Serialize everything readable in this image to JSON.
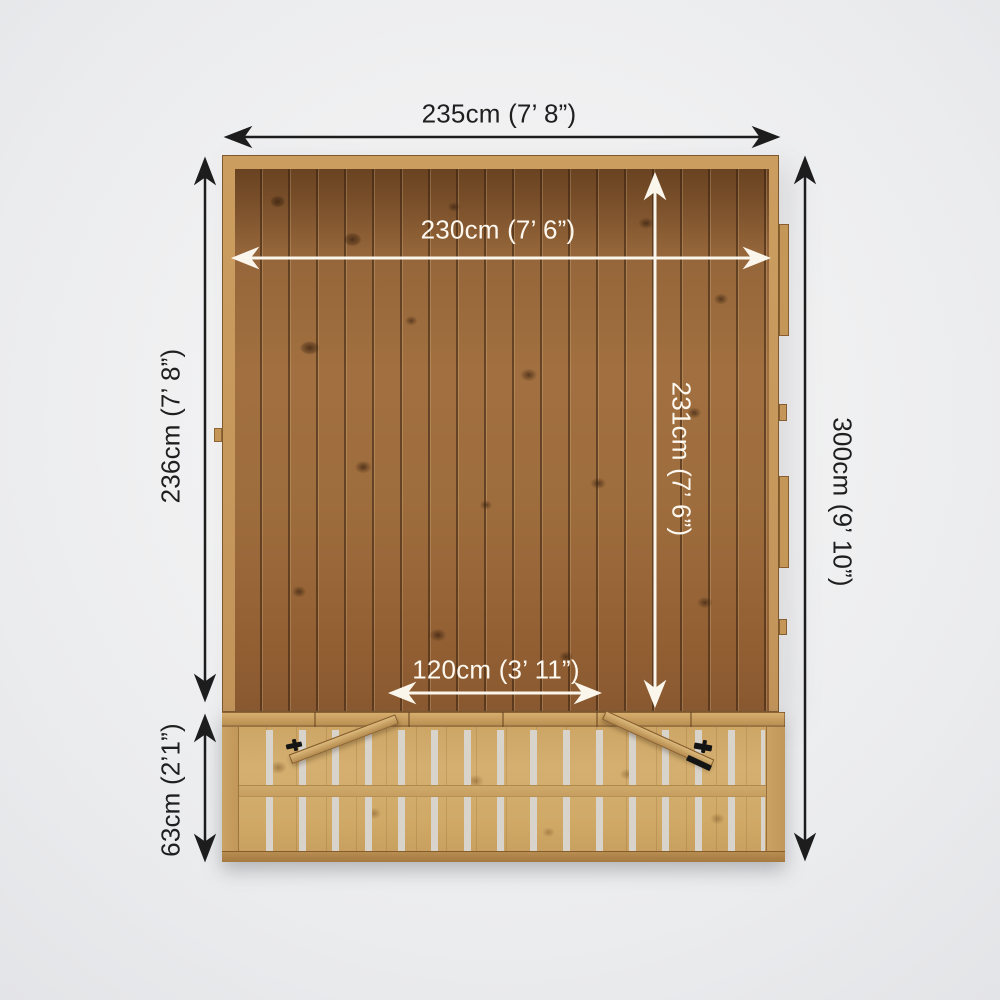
{
  "diagram": {
    "type": "product-dimension-floorplan",
    "subject": "Wooden summerhouse floor with veranda decking and open double doors, top view with dimension arrows",
    "dimensions": {
      "external_width": "235cm (7’ 8”)",
      "internal_width": "230cm (7’ 6”)",
      "external_depth": "236cm (7’ 8”)",
      "internal_depth": "231cm (7’ 6”)",
      "overall_depth": "300cm (9’ 10”)",
      "door_opening_width": "120cm (3’ 11”)",
      "veranda_depth": "63cm (2’1”)"
    },
    "colors": {
      "background": "#ebecee",
      "floor_wood": "#9a6a3e",
      "deck_wood": "#cfa968",
      "frame_wood": "#c89a5c",
      "dimension_black": "#1d1d1d",
      "dimension_white": "#fbf6ec"
    }
  }
}
